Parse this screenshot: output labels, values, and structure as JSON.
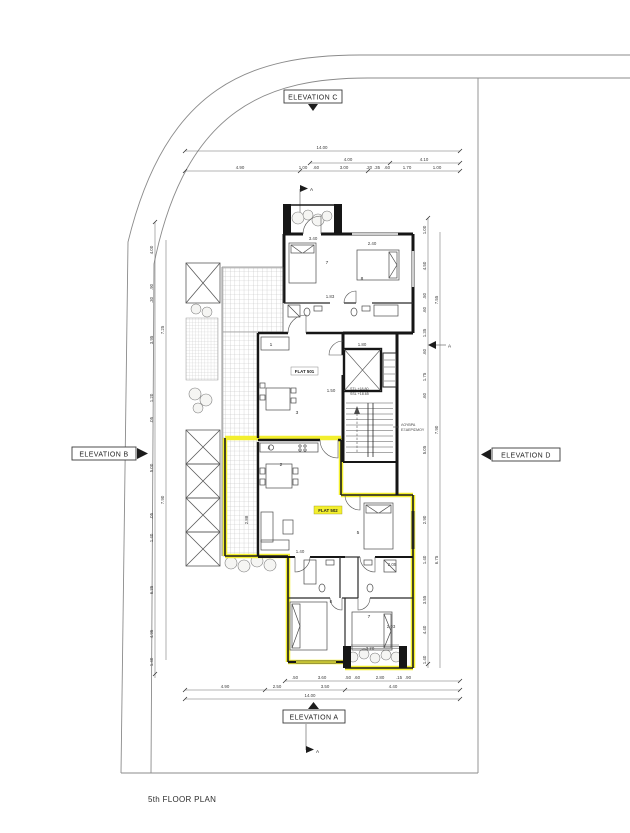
{
  "title": "5th FLOOR PLAN",
  "elevations": {
    "top": "ELEVATION C",
    "bottom": "ELEVATION A",
    "left": "ELEVATION B",
    "right": "ELEVATION D"
  },
  "markers": {
    "top": "A",
    "bottom": "A",
    "side": "A"
  },
  "flats": {
    "upper": "FLAT 501",
    "lower": "FLAT 502"
  },
  "core": {
    "louvre1": "ΛΟΥΒΡΑ",
    "louvre2": "ΕΞΑΕΡΙΣΜΟΥ",
    "level1": "STL +18.80",
    "level2": "SSL +18.65"
  },
  "colors": {
    "highlight": "#f3ef2e",
    "wall": "#161616",
    "boundary": "#8b8b8b",
    "hatch": "#bcbcbc"
  },
  "dims": {
    "top_row1": [
      {
        "t": "14.00"
      }
    ],
    "top_row2": [
      {
        "t": "4.00"
      },
      {
        "t": "4.10"
      }
    ],
    "top_row3": [
      {
        "t": "4.90"
      },
      {
        "t": "1.00"
      },
      {
        "t": ".60"
      },
      {
        "t": "3.00"
      },
      {
        "t": ".20"
      },
      {
        "t": ".35"
      },
      {
        "t": ".60"
      },
      {
        "t": "1.70"
      },
      {
        "t": "1.00"
      }
    ],
    "bottom_row1": [
      {
        "t": ".50"
      },
      {
        "t": "3.60"
      },
      {
        "t": ".50"
      },
      {
        "t": ".60"
      },
      {
        "t": "2.80"
      },
      {
        "t": ".15"
      },
      {
        "t": ".90"
      }
    ],
    "bottom_row2": [
      {
        "t": "4.90"
      },
      {
        "t": "2.50"
      },
      {
        "t": "3.50"
      },
      {
        "t": "4.40"
      }
    ],
    "bottom_row3": [
      {
        "t": "14.00"
      }
    ],
    "left_col": [
      {
        "t": "4.00"
      },
      {
        "t": ".90"
      },
      {
        "t": ".30"
      },
      {
        "t": "3.95"
      },
      {
        "t": "1.20"
      },
      {
        "t": ".05"
      },
      {
        "t": "5.00"
      },
      {
        "t": ".05"
      },
      {
        "t": "1.40"
      },
      {
        "t": "6.35"
      },
      {
        "t": "4.95"
      },
      {
        "t": "1.40"
      }
    ],
    "left_col2": [
      {
        "t": "7.25"
      },
      {
        "t": "7.90"
      }
    ],
    "right_col": [
      {
        "t": "1.00"
      },
      {
        "t": "4.50"
      },
      {
        "t": ".50"
      },
      {
        "t": ".60"
      },
      {
        "t": "1.35"
      },
      {
        "t": ".60"
      },
      {
        "t": "1.75"
      },
      {
        "t": ".60"
      },
      {
        "t": "5.05"
      },
      {
        "t": "2.90"
      },
      {
        "t": "1.40"
      },
      {
        "t": "3.55"
      },
      {
        "t": "4.40"
      },
      {
        "t": "1.40"
      }
    ],
    "right_col2": [
      {
        "t": "7.55"
      },
      {
        "t": "7.90"
      },
      {
        "t": "6.75"
      }
    ],
    "plan": [
      {
        "t": "3.40"
      },
      {
        "t": "2.40"
      },
      {
        "t": "1.83"
      },
      {
        "t": "1.80"
      },
      {
        "t": "1.50"
      },
      {
        "t": "2.88"
      },
      {
        "t": "1.40"
      },
      {
        "t": "2.03"
      },
      {
        "t": "3.20"
      },
      {
        "t": "2.05"
      }
    ],
    "rooms": [
      {
        "t": "7"
      },
      {
        "t": "8"
      },
      {
        "t": "1"
      },
      {
        "t": "3"
      },
      {
        "t": "4"
      },
      {
        "t": "2"
      },
      {
        "t": "5"
      },
      {
        "t": "6"
      },
      {
        "t": "7"
      }
    ]
  }
}
